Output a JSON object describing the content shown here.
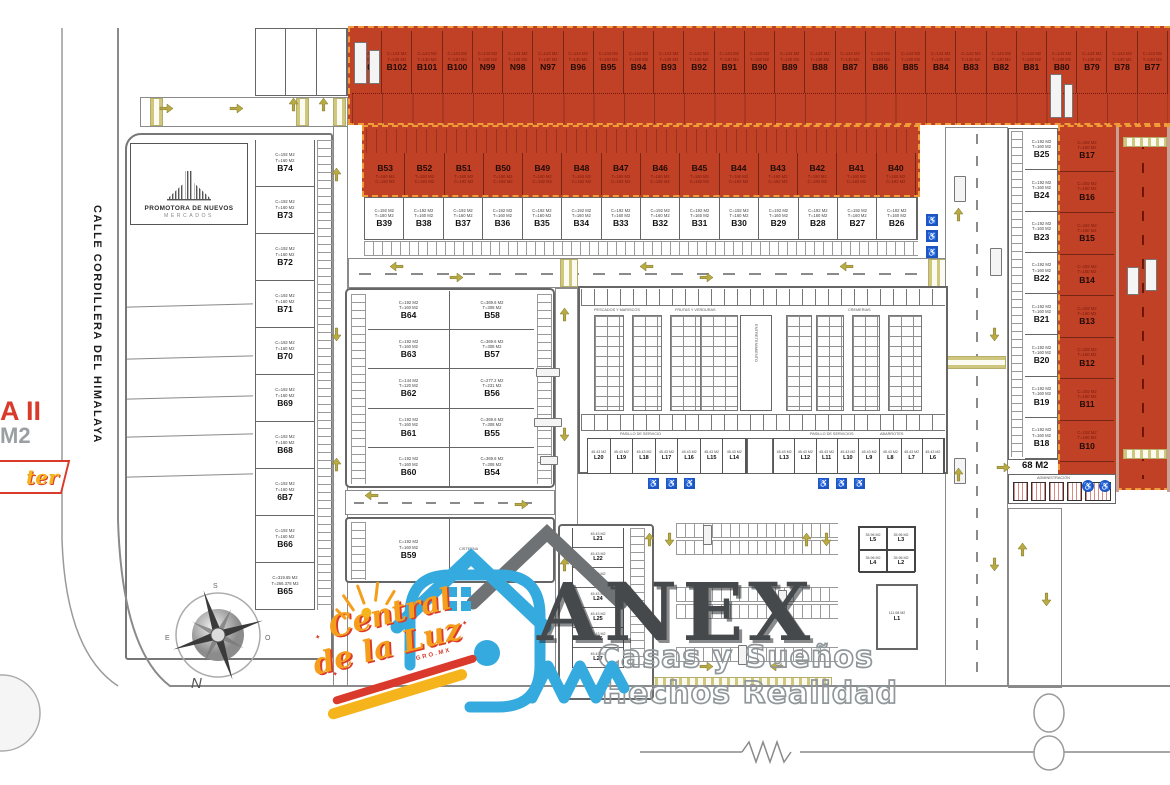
{
  "street": {
    "name": "CALLE CORDILLERA DEL HIMALAYA"
  },
  "promotora": {
    "line1": "PROMOTORA DE NUEVOS",
    "line2": "MERCADOS"
  },
  "badge": {
    "line1": "A II",
    "line2": "M2",
    "script": "ter"
  },
  "compass": {
    "n": "N",
    "s": "S",
    "e": "E",
    "o": "O"
  },
  "top_row": {
    "spec1": "C=144 M2",
    "spec2": "T=130 M2",
    "lots": [
      "B103",
      "B102",
      "B101",
      "B100",
      "N99",
      "N98",
      "N97",
      "B96",
      "B95",
      "B94",
      "B93",
      "B92",
      "B91",
      "B90",
      "B89",
      "B88",
      "B87",
      "B86",
      "B85",
      "B84",
      "B83",
      "B82",
      "B81",
      "B80",
      "B79",
      "B78",
      "B77"
    ]
  },
  "row_red": {
    "spec1": "T=160 M2",
    "spec2": "C=192 M2",
    "lots": [
      "B53",
      "B52",
      "B51",
      "B50",
      "B49",
      "B48",
      "B47",
      "B46",
      "B45",
      "B44",
      "B43",
      "B42",
      "B41",
      "B40"
    ]
  },
  "row_white": {
    "spec1": "C=192 M2",
    "spec2": "T=160 M2",
    "lots": [
      "B39",
      "B38",
      "B37",
      "B36",
      "B35",
      "B34",
      "B33",
      "B32",
      "B31",
      "B30",
      "B29",
      "B28",
      "B27",
      "B26"
    ]
  },
  "left_col": {
    "lots": [
      {
        "spec1": "C=192 M2",
        "spec2": "T=160 M2",
        "n": "B74"
      },
      {
        "spec1": "C=192 M2",
        "spec2": "T=160 M2",
        "n": "B73"
      },
      {
        "spec1": "C=192 M2",
        "spec2": "T=160 M2",
        "n": "B72"
      },
      {
        "spec1": "C=192 M2",
        "spec2": "T=160 M2",
        "n": "B71"
      },
      {
        "spec1": "C=192 M2",
        "spec2": "T=160 M2",
        "n": "B70"
      },
      {
        "spec1": "C=192 M2",
        "spec2": "T=160 M2",
        "n": "B69"
      },
      {
        "spec1": "C=192 M2",
        "spec2": "T=160 M2",
        "n": "B68"
      },
      {
        "spec1": "C=192 M2",
        "spec2": "T=160 M2",
        "n": "6B7"
      },
      {
        "spec1": "C=192 M2",
        "spec2": "T=160 M2",
        "n": "B66"
      },
      {
        "spec1": "C=319.65 M2",
        "spec2": "T=266.378 M2",
        "n": "B65"
      }
    ]
  },
  "mid_left": {
    "lots": [
      {
        "spec1": "C=192 M2",
        "spec2": "T=160 M2",
        "n": "B64"
      },
      {
        "spec1": "C=192 M2",
        "spec2": "T=160 M2",
        "n": "B63"
      },
      {
        "spec1": "C=144 M2",
        "spec2": "T=120 M2",
        "n": "B62"
      },
      {
        "spec1": "C=192 M2",
        "spec2": "T=160 M2",
        "n": "B61"
      },
      {
        "spec1": "C=192 M2",
        "spec2": "T=160 M2",
        "n": "B60"
      }
    ]
  },
  "mid_right": {
    "lots": [
      {
        "spec1": "C=369.6 M2",
        "spec2": "T=308 M2",
        "n": "B58"
      },
      {
        "spec1": "C=369.6 M2",
        "spec2": "T=308 M2",
        "n": "B57"
      },
      {
        "spec1": "C=277.2 M2",
        "spec2": "T=231 M2",
        "n": "B56"
      },
      {
        "spec1": "C=369.6 M2",
        "spec2": "T=308 M2",
        "n": "B55"
      },
      {
        "spec1": "C=369.6 M2",
        "spec2": "T=308 M2",
        "n": "B54"
      }
    ]
  },
  "b59": {
    "spec1": "C=192 M2",
    "spec2": "T=160 M2",
    "n": "B59"
  },
  "cisterna": "CISTERNA",
  "right_white": {
    "spec1": "C=192 M2",
    "spec2": "T=160 M2",
    "lots": [
      "B25",
      "B24",
      "B23",
      "B22",
      "B21",
      "B20",
      "B19",
      "B18"
    ]
  },
  "right_red": {
    "spec1": "C=192 M2",
    "spec2": "T=160 M2",
    "lots": [
      "B17",
      "B16",
      "B15",
      "B14",
      "B13",
      "B12",
      "B11",
      "B10"
    ]
  },
  "loc_row_left": {
    "area": "45.43 M2",
    "lots": [
      "L20",
      "L19",
      "L18",
      "L17",
      "L16",
      "L15",
      "L14"
    ]
  },
  "loc_row_right": {
    "area": "45.43 M2",
    "lots": [
      "L13",
      "L12",
      "L11",
      "L10",
      "L9",
      "L8",
      "L7",
      "L6"
    ]
  },
  "loc_col": {
    "area": "45.43 M2",
    "lots": [
      "L21",
      "L22",
      "L23",
      "L24",
      "L25",
      "L26",
      "L27"
    ]
  },
  "loc_sw": {
    "area": "35.96 M2",
    "lots": [
      "L5",
      "L3",
      "L4",
      "L2"
    ]
  },
  "local_l1": {
    "area": "111.08 M2",
    "n": "L1"
  },
  "market": {
    "zone1": "PESCADOS Y MARISCOS",
    "zone2": "FRUTAS Y VERDURAS",
    "zone3": "CREMERIAS",
    "zone4": "ABARROTES",
    "center": "ENTRETENIMIENTO",
    "pasillo_left": "PASILLO DE SERVICIO",
    "pasillo_right": "PASILLO DE SERVICIOS"
  },
  "admin": {
    "area": "68 M2",
    "name": "ADMINISTRACIÓN"
  },
  "watermark": {
    "title": "ANEX",
    "sub1": "Casas y Sueños",
    "sub2": "Hechos Realidad"
  },
  "brand": {
    "l1": "Central",
    "l2": "de la Luz",
    "sub": "GRO.MX"
  }
}
